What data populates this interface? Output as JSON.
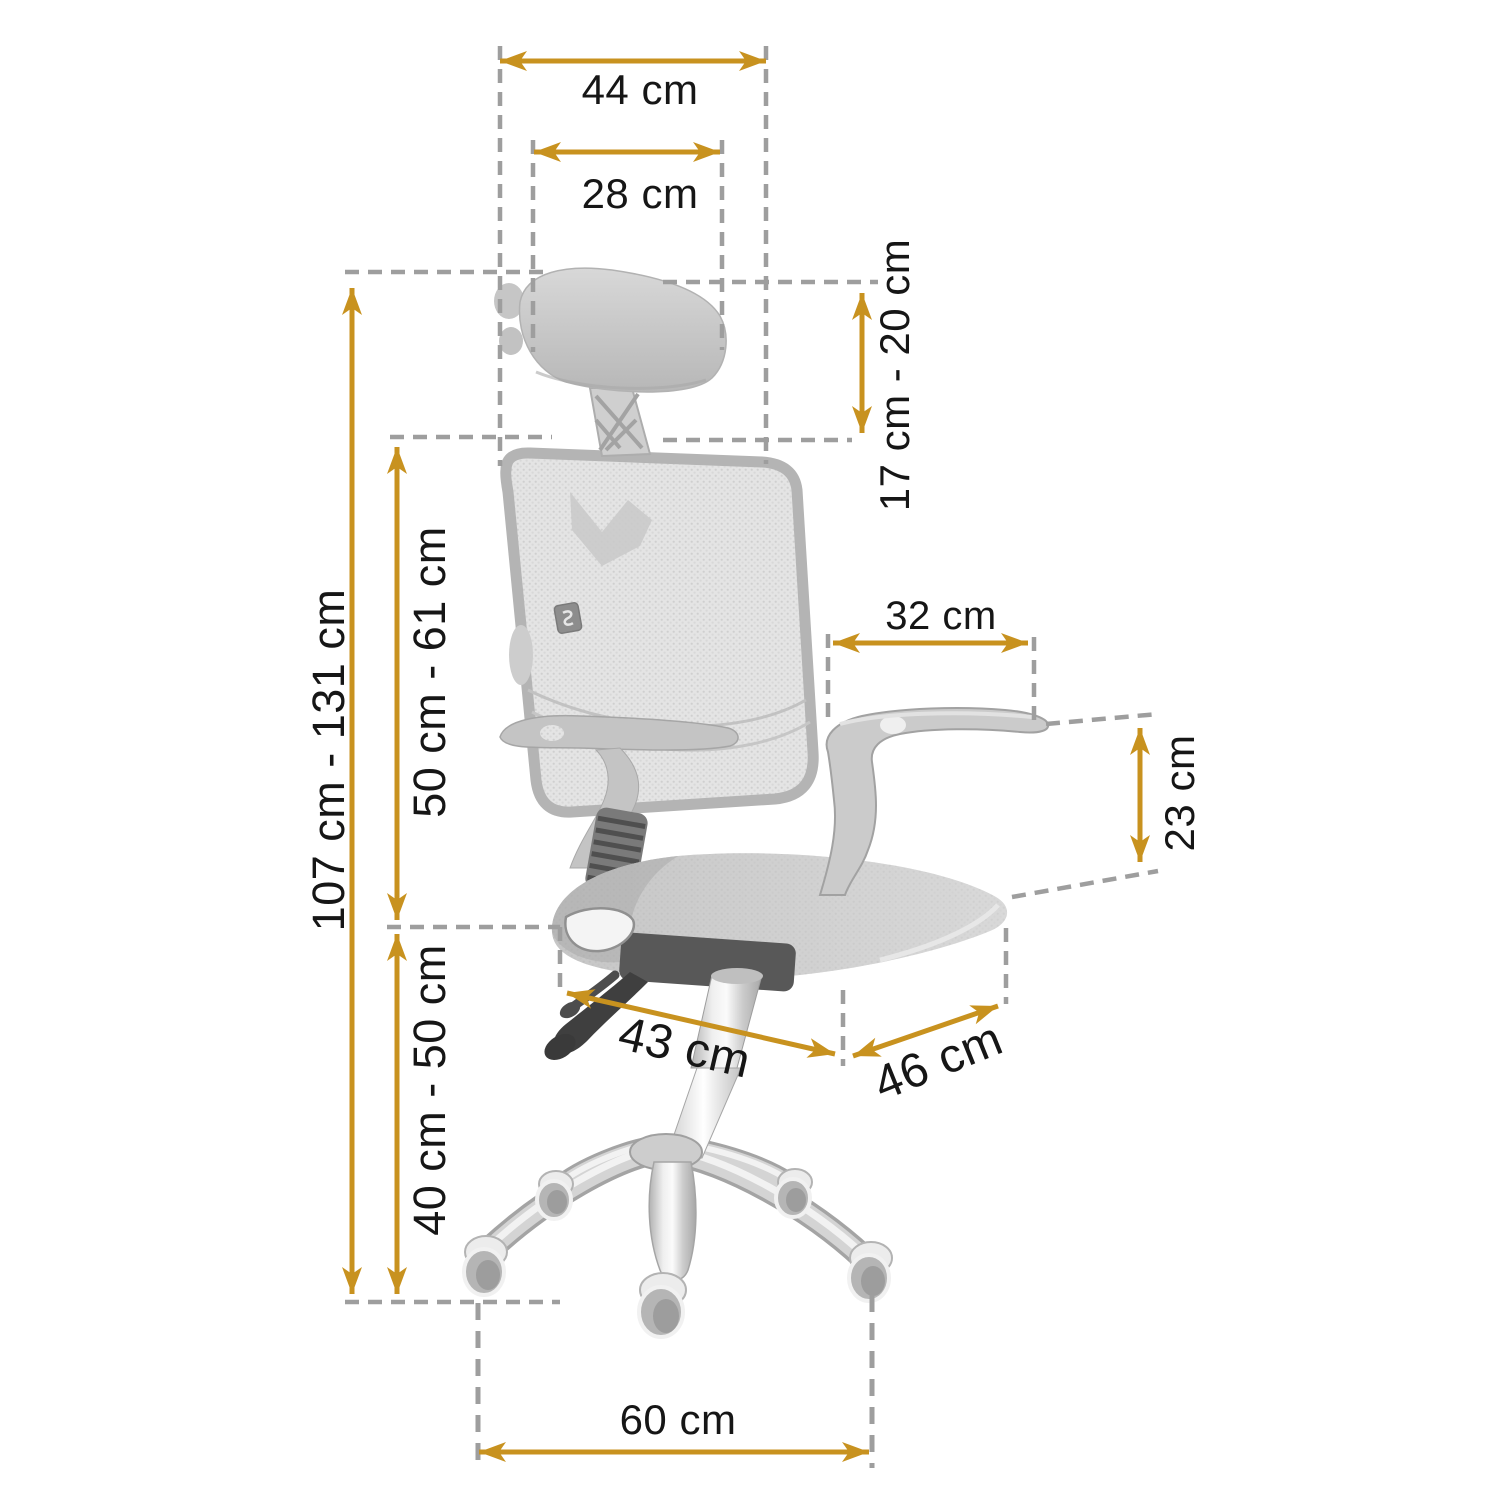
{
  "diagram": {
    "title": "office chair dimension diagram",
    "subject": "ergonomic mesh office chair, side view, grayscale product photo with measurement overlays",
    "unit": "cm",
    "colors": {
      "arrow": "#c8921f",
      "guide_dash": "#9e9e9e",
      "label_text": "#161616",
      "background": "#ffffff",
      "chair_light_gray": "#d6d6d6",
      "chair_dark_gray": "#4a4a4a"
    },
    "measurements": [
      {
        "id": "headrest-outer-width",
        "label": "44 cm",
        "orientation": "horizontal"
      },
      {
        "id": "headrest-cushion-width",
        "label": "28 cm",
        "orientation": "horizontal"
      },
      {
        "id": "headrest-height-range",
        "label": "17 cm - 20 cm",
        "orientation": "vertical"
      },
      {
        "id": "total-height-range",
        "label": "107 cm - 131 cm",
        "orientation": "vertical"
      },
      {
        "id": "backrest-height-range",
        "label": "50 cm - 61 cm",
        "orientation": "vertical"
      },
      {
        "id": "seat-height-range",
        "label": "40 cm - 50 cm",
        "orientation": "vertical"
      },
      {
        "id": "armrest-length",
        "label": "32 cm",
        "orientation": "horizontal"
      },
      {
        "id": "armrest-height",
        "label": "23 cm",
        "orientation": "vertical"
      },
      {
        "id": "seat-depth",
        "label": "43 cm",
        "orientation": "diagonal"
      },
      {
        "id": "seat-width",
        "label": "46 cm",
        "orientation": "diagonal"
      },
      {
        "id": "base-diameter",
        "label": "60 cm",
        "orientation": "horizontal"
      }
    ]
  }
}
